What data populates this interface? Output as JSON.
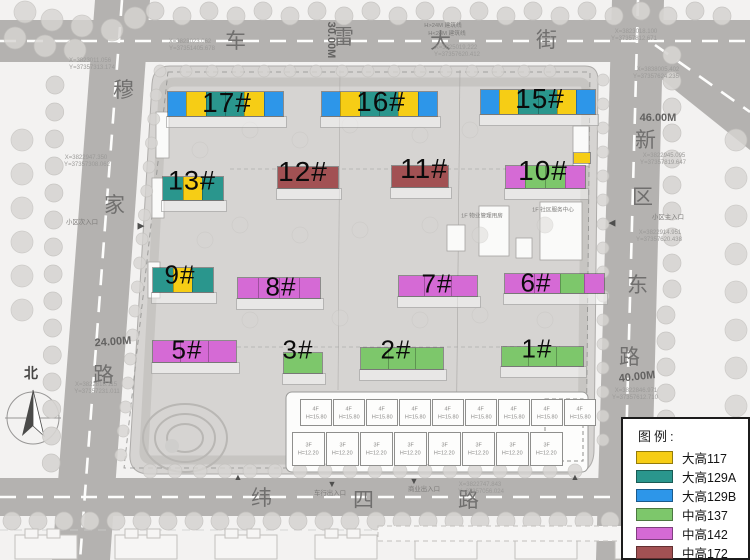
{
  "colors": {
    "yellow": "#F6CD15",
    "teal": "#2A968D",
    "blue": "#2D96E9",
    "green": "#7DC76B",
    "magenta": "#D56AD5",
    "maroon": "#A25153"
  },
  "legend": {
    "title": "图例:",
    "items": [
      {
        "label": "大高117",
        "color": "#F6CD15"
      },
      {
        "label": "大高129A",
        "color": "#2A968D"
      },
      {
        "label": "大高129B",
        "color": "#2D96E9"
      },
      {
        "label": "中高137",
        "color": "#7DC76B"
      },
      {
        "label": "中高142",
        "color": "#D56AD5"
      },
      {
        "label": "中高172",
        "color": "#A25153"
      }
    ]
  },
  "buildings": [
    {
      "label": "17#",
      "x": 168,
      "y": 92,
      "w": 115,
      "h": 24,
      "fs": 28,
      "lx": 227,
      "ly": 103,
      "segs": [
        [
          "blue",
          1
        ],
        [
          "yellow",
          1
        ],
        [
          "teal",
          1
        ],
        [
          "teal",
          1
        ],
        [
          "yellow",
          1
        ],
        [
          "blue",
          1
        ]
      ]
    },
    {
      "label": "16#",
      "x": 322,
      "y": 92,
      "w": 115,
      "h": 24,
      "fs": 28,
      "lx": 381,
      "ly": 102,
      "segs": [
        [
          "blue",
          1
        ],
        [
          "yellow",
          1
        ],
        [
          "teal",
          1
        ],
        [
          "teal",
          1
        ],
        [
          "yellow",
          1
        ],
        [
          "blue",
          1
        ]
      ]
    },
    {
      "label": "15#",
      "x": 481,
      "y": 90,
      "w": 114,
      "h": 24,
      "fs": 28,
      "lx": 540,
      "ly": 99,
      "segs": [
        [
          "blue",
          1
        ],
        [
          "yellow",
          1
        ],
        [
          "teal",
          1
        ],
        [
          "teal",
          1
        ],
        [
          "yellow",
          1
        ],
        [
          "blue",
          1
        ]
      ]
    },
    {
      "label": "13#",
      "x": 163,
      "y": 177,
      "w": 60,
      "h": 23,
      "fs": 27,
      "lx": 192,
      "ly": 181,
      "segs": [
        [
          "teal",
          1
        ],
        [
          "yellow",
          0.9
        ],
        [
          "teal",
          1
        ]
      ]
    },
    {
      "label": "12#",
      "x": 278,
      "y": 167,
      "w": 60,
      "h": 21,
      "fs": 28,
      "lx": 303,
      "ly": 172,
      "segs": [
        [
          "maroon",
          1
        ]
      ]
    },
    {
      "label": "11#",
      "x": 392,
      "y": 166,
      "w": 56,
      "h": 21,
      "fs": 28,
      "lx": 424,
      "ly": 169,
      "segs": [
        [
          "maroon",
          1
        ]
      ]
    },
    {
      "label": "10#",
      "x": 506,
      "y": 166,
      "w": 79,
      "h": 22,
      "fs": 28,
      "lx": 543,
      "ly": 171,
      "segs": [
        [
          "magenta",
          1
        ],
        [
          "green",
          1
        ],
        [
          "green",
          1
        ],
        [
          "magenta",
          1
        ]
      ]
    },
    {
      "label": "",
      "x": 574,
      "y": 153,
      "w": 16,
      "h": 10,
      "segs": [
        [
          "yellow",
          1
        ]
      ]
    },
    {
      "label": "9#",
      "x": 153,
      "y": 268,
      "w": 60,
      "h": 24,
      "fs": 26,
      "lx": 180,
      "ly": 275,
      "segs": [
        [
          "teal",
          1
        ],
        [
          "yellow",
          0.9
        ],
        [
          "teal",
          1
        ]
      ]
    },
    {
      "label": "8#",
      "x": 238,
      "y": 278,
      "w": 82,
      "h": 20,
      "fs": 26,
      "lx": 281,
      "ly": 287,
      "segs": [
        [
          "magenta",
          1
        ],
        [
          "magenta",
          1
        ],
        [
          "magenta",
          1
        ],
        [
          "magenta",
          1
        ]
      ]
    },
    {
      "label": "7#",
      "x": 399,
      "y": 276,
      "w": 78,
      "h": 20,
      "fs": 26,
      "lx": 437,
      "ly": 284,
      "segs": [
        [
          "magenta",
          1
        ],
        [
          "magenta",
          1
        ],
        [
          "magenta",
          1
        ]
      ]
    },
    {
      "label": "6#",
      "x": 505,
      "y": 274,
      "w": 99,
      "h": 19,
      "fs": 26,
      "lx": 536,
      "ly": 283,
      "segs": [
        [
          "magenta",
          0.3
        ],
        [
          "magenta",
          0.26
        ],
        [
          "green",
          0.24
        ],
        [
          "magenta",
          0.2
        ]
      ]
    },
    {
      "label": "5#",
      "x": 153,
      "y": 341,
      "w": 83,
      "h": 21,
      "fs": 26,
      "lx": 187,
      "ly": 350,
      "segs": [
        [
          "magenta",
          1
        ],
        [
          "magenta",
          1
        ],
        [
          "magenta",
          1
        ]
      ]
    },
    {
      "label": "3#",
      "x": 284,
      "y": 353,
      "w": 38,
      "h": 20,
      "fs": 26,
      "lx": 298,
      "ly": 350,
      "segs": [
        [
          "green",
          1
        ]
      ]
    },
    {
      "label": "2#",
      "x": 361,
      "y": 348,
      "w": 82,
      "h": 21,
      "fs": 26,
      "lx": 396,
      "ly": 350,
      "segs": [
        [
          "green",
          1
        ],
        [
          "green",
          1
        ],
        [
          "green",
          1
        ]
      ]
    },
    {
      "label": "1#",
      "x": 502,
      "y": 347,
      "w": 81,
      "h": 19,
      "fs": 26,
      "lx": 537,
      "ly": 349,
      "segs": [
        [
          "green",
          1
        ],
        [
          "green",
          1
        ],
        [
          "green",
          1
        ]
      ]
    }
  ],
  "map_labels": [
    {
      "t": "车",
      "x": 236,
      "y": 40,
      "cls": "rc",
      "n": "road-label-top"
    },
    {
      "t": "雷",
      "x": 344,
      "y": 36,
      "cls": "rc",
      "n": "road-label-top"
    },
    {
      "t": "大",
      "x": 441,
      "y": 40,
      "cls": "rc",
      "n": "road-label-top"
    },
    {
      "t": "街",
      "x": 547,
      "y": 39,
      "cls": "rc",
      "n": "road-label-top"
    },
    {
      "t": "新",
      "x": 646,
      "y": 139,
      "cls": "rc",
      "n": "road-label-right"
    },
    {
      "t": "区",
      "x": 643,
      "y": 196,
      "cls": "rc",
      "n": "road-label-right"
    },
    {
      "t": "东",
      "x": 638,
      "y": 284,
      "cls": "rc",
      "n": "road-label-right"
    },
    {
      "t": "路",
      "x": 630,
      "y": 356,
      "cls": "rc",
      "n": "road-label-right"
    },
    {
      "t": "穆",
      "x": 124,
      "y": 89,
      "cls": "rc",
      "n": "road-label-left"
    },
    {
      "t": "家",
      "x": 115,
      "y": 204,
      "cls": "rc",
      "n": "road-label-left"
    },
    {
      "t": "路",
      "x": 104,
      "y": 374,
      "cls": "rc",
      "n": "road-label-left"
    },
    {
      "t": "纬",
      "x": 262,
      "y": 497,
      "cls": "rc",
      "n": "road-label-bottom"
    },
    {
      "t": "四",
      "x": 364,
      "y": 499,
      "cls": "rc",
      "n": "road-label-bottom"
    },
    {
      "t": "路",
      "x": 469,
      "y": 499,
      "cls": "rc",
      "n": "road-label-bottom"
    },
    {
      "t": "30.00M",
      "x": 331,
      "y": 40,
      "cls": "dim",
      "rot": 90,
      "n": "road-width-label"
    },
    {
      "t": "46.00M",
      "x": 658,
      "y": 118,
      "cls": "dim",
      "n": "road-width-label"
    },
    {
      "t": "24.00M",
      "x": 113,
      "y": 342,
      "cls": "dim",
      "rot": -4,
      "n": "road-width-label"
    },
    {
      "t": "40.00M",
      "x": 637,
      "y": 377,
      "cls": "dim",
      "rot": -6,
      "n": "road-width-label"
    },
    {
      "t": "北",
      "x": 31,
      "y": 373,
      "cls": "north",
      "n": "north-label"
    },
    {
      "t": "X=3823011.056",
      "x": 90,
      "y": 60,
      "cls": "co",
      "sc": 0.75,
      "n": "coordinate-label"
    },
    {
      "t": "Y=37357313.174",
      "x": 92,
      "y": 67,
      "cls": "co",
      "sc": 0.75,
      "n": "coordinate-label"
    },
    {
      "t": "X=3823023.062",
      "x": 190,
      "y": 41,
      "cls": "co",
      "sc": 0.75,
      "n": "coordinate-label"
    },
    {
      "t": "Y=37351405.678",
      "x": 192,
      "y": 48,
      "cls": "co",
      "sc": 0.75,
      "n": "coordinate-label"
    },
    {
      "t": "X=3823018.100",
      "x": 636,
      "y": 31,
      "cls": "co",
      "sc": 0.75,
      "n": "coordinate-label"
    },
    {
      "t": "Y=37357812.671",
      "x": 634,
      "y": 38,
      "cls": "co",
      "sc": 0.75,
      "n": "coordinate-label"
    },
    {
      "t": "X=3838005.402",
      "x": 658,
      "y": 69,
      "cls": "co",
      "sc": 0.75,
      "n": "coordinate-label"
    },
    {
      "t": "Y=37357624.235",
      "x": 656,
      "y": 76,
      "cls": "co",
      "sc": 0.75,
      "n": "coordinate-label"
    },
    {
      "t": "X=3822945.095",
      "x": 664,
      "y": 155,
      "cls": "co",
      "sc": 0.75,
      "n": "coordinate-label"
    },
    {
      "t": "Y=37357819.647",
      "x": 663,
      "y": 162,
      "cls": "co",
      "sc": 0.75,
      "n": "coordinate-label"
    },
    {
      "t": "X=3822914.951",
      "x": 660,
      "y": 232,
      "cls": "co",
      "sc": 0.75,
      "n": "coordinate-label"
    },
    {
      "t": "Y=37357620.438",
      "x": 659,
      "y": 239,
      "cls": "co",
      "sc": 0.75,
      "n": "coordinate-label"
    },
    {
      "t": "X=3822846.971",
      "x": 636,
      "y": 390,
      "cls": "co",
      "sc": 0.75,
      "n": "coordinate-label"
    },
    {
      "t": "Y=37357612.710",
      "x": 635,
      "y": 397,
      "cls": "co",
      "sc": 0.75,
      "n": "coordinate-label"
    },
    {
      "t": "X=3822947.350",
      "x": 86,
      "y": 157,
      "cls": "co",
      "sc": 0.75,
      "n": "coordinate-label"
    },
    {
      "t": "Y=37357308.062",
      "x": 87,
      "y": 164,
      "cls": "co",
      "sc": 0.75,
      "n": "coordinate-label"
    },
    {
      "t": "X=3822818.115",
      "x": 96,
      "y": 384,
      "cls": "co",
      "sc": 0.75,
      "n": "coordinate-label"
    },
    {
      "t": "Y=37357231.011",
      "x": 97,
      "y": 391,
      "cls": "co",
      "sc": 0.75,
      "n": "coordinate-label"
    },
    {
      "t": "X=3822747.843",
      "x": 480,
      "y": 484,
      "cls": "co",
      "sc": 0.75,
      "n": "coordinate-label"
    },
    {
      "t": "Y=37357056.024",
      "x": 481,
      "y": 491,
      "cls": "co",
      "sc": 0.75,
      "n": "coordinate-label"
    },
    {
      "t": "X=3825019.222",
      "x": 456,
      "y": 47,
      "cls": "co",
      "sc": 0.75,
      "n": "coordinate-label"
    },
    {
      "t": "Y=37357620.412",
      "x": 457,
      "y": 54,
      "cls": "co",
      "sc": 0.75,
      "n": "coordinate-label"
    },
    {
      "t": "小区次入口",
      "x": 82,
      "y": 222,
      "cls": "nt",
      "sc": 0.8,
      "n": "entrance-label"
    },
    {
      "t": "小区主入口",
      "x": 668,
      "y": 217,
      "cls": "nt",
      "sc": 0.8,
      "n": "entrance-label"
    },
    {
      "t": "车行出入口",
      "x": 330,
      "y": 493,
      "cls": "nt",
      "sc": 0.8,
      "n": "entrance-label"
    },
    {
      "t": "商业出入口",
      "x": 424,
      "y": 489,
      "cls": "nt",
      "sc": 0.8,
      "n": "entrance-label"
    },
    {
      "t": "H>24M 建筑线",
      "x": 443,
      "y": 25,
      "cls": "nt",
      "sc": 0.72,
      "n": "setback-note"
    },
    {
      "t": "H<24M 建筑线",
      "x": 447,
      "y": 33,
      "cls": "nt",
      "sc": 0.72,
      "n": "setback-note"
    },
    {
      "t": "1F 物业管理用房",
      "x": 482,
      "y": 216,
      "cls": "nt",
      "sc": 0.7,
      "n": "facility-label"
    },
    {
      "t": "1F 社区服务中心",
      "x": 553,
      "y": 210,
      "cls": "nt",
      "sc": 0.7,
      "n": "facility-label"
    },
    {
      "t": "▲",
      "x": 238,
      "y": 477,
      "cls": "mk",
      "n": "entrance-marker"
    },
    {
      "t": "▼",
      "x": 332,
      "y": 484,
      "cls": "mk",
      "n": "entrance-marker"
    },
    {
      "t": "▼",
      "x": 414,
      "y": 481,
      "cls": "mk",
      "n": "entrance-marker"
    },
    {
      "t": "▲",
      "x": 575,
      "y": 477,
      "cls": "mk",
      "n": "entrance-marker"
    },
    {
      "t": "◀",
      "x": 612,
      "y": 223,
      "cls": "mk",
      "n": "entrance-marker"
    },
    {
      "t": "▶",
      "x": 141,
      "y": 226,
      "cls": "mk",
      "n": "entrance-marker"
    }
  ],
  "commercial": {
    "top_row": {
      "n": 9,
      "label": "4F",
      "height_label": "H=15.80"
    },
    "bottom_row": {
      "n": 8,
      "label": "3F",
      "height_label": "H=12.20"
    }
  }
}
